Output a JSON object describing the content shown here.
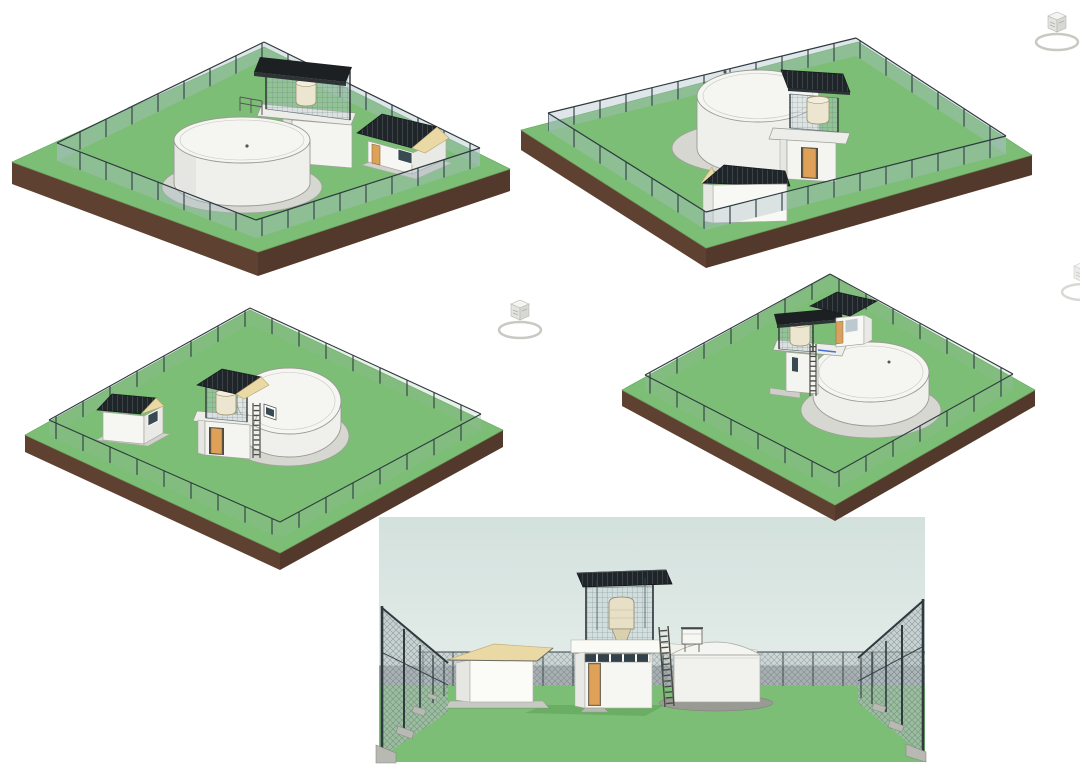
{
  "canvas": {
    "width": 1080,
    "height": 769,
    "background": "#ffffff"
  },
  "views": [
    {
      "id": "view-3d-1",
      "label": "3D isometric view 1 - fenced water tank compound from north-west",
      "type": "isometric-render"
    },
    {
      "id": "view-3d-2",
      "label": "3D isometric view 2 - fenced water tank compound from north-east",
      "type": "isometric-render"
    },
    {
      "id": "view-3d-3",
      "label": "3D isometric view 3 - fenced water tank compound from south-west",
      "type": "isometric-render"
    },
    {
      "id": "view-3d-4",
      "label": "3D isometric view 4 - fenced water tank compound from south-east",
      "type": "isometric-render"
    },
    {
      "id": "view-3d-5",
      "label": "3D perspective view - eye level inside fenced compound",
      "type": "perspective-render"
    }
  ],
  "icons": {
    "viewcube": {
      "name": "viewcube-icon",
      "count": 3,
      "label": "3D navigation view cube"
    }
  },
  "scene_elements": [
    "grass plot",
    "earth base slab",
    "chain-link perimeter fence",
    "circular water storage tank",
    "tower with elevated tank cage",
    "solar panel roof",
    "guard house",
    "ladder",
    "access door",
    "tank pad"
  ],
  "colors": {
    "grass": "#7CBE76",
    "grass_shadow": "#5FA359",
    "earth_front": "#5E4130",
    "earth_side": "#53392B",
    "fence_post": "#2E3A3E",
    "fence_mesh": "rgba(168,190,196,0.38)",
    "roof_dark": "#20252A",
    "roof_rib": "#3A4348",
    "roof_cream": "#EAD9A4",
    "wall_white": "#F6F6F2",
    "wall_shade": "#E6E6E2",
    "tank_white": "#F1F1ED",
    "tank_pad": "#D7D7D1",
    "door_orange": "#DFA058",
    "window_dark": "#3A4A52",
    "small_tank_cream": "#ECE5CF",
    "sky_top": "#D3E1DD",
    "sky_bottom": "#E5EDEA",
    "horizon_wall": "#9CA2A5",
    "ladder": "#4A4A46",
    "pipe_blue": "#4A6FD4",
    "viewcube_gray": "#E3E3DF"
  }
}
